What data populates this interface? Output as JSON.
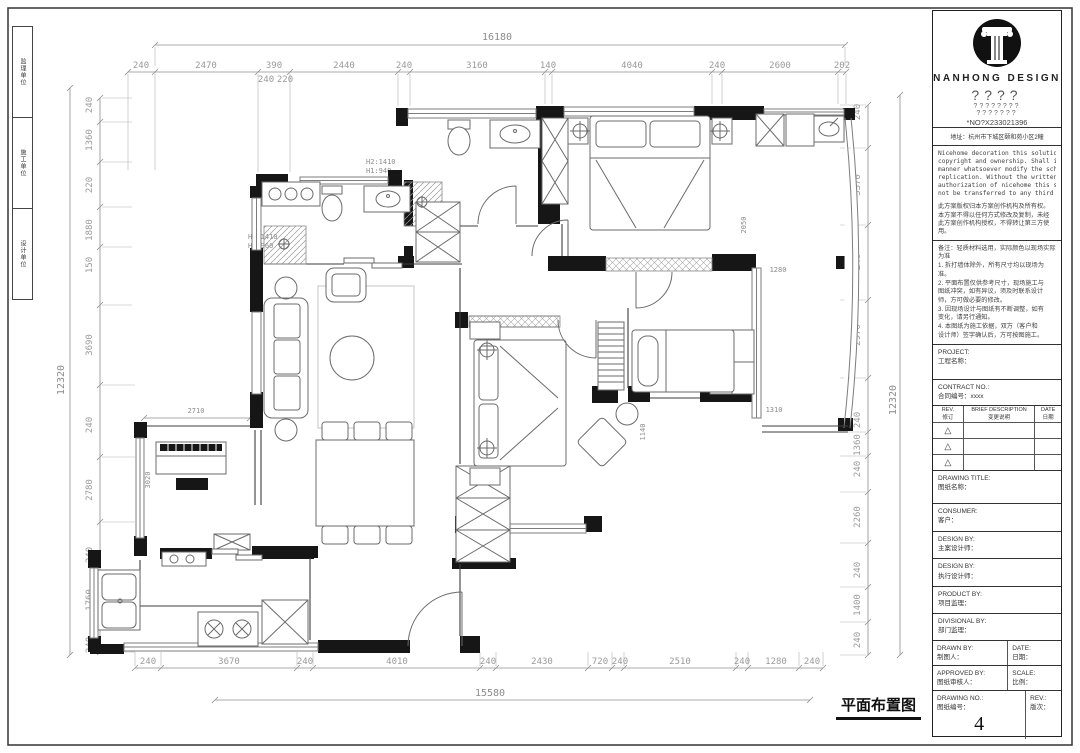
{
  "sheet": {
    "drawing_label": "平面布置图",
    "side_strip": [
      "监理单位",
      "施工单位",
      "设计单位"
    ]
  },
  "dimensions": {
    "top": {
      "total": "16180",
      "segments": [
        "240",
        "2470",
        "390",
        "2440",
        "240",
        "3160",
        "140",
        "4040",
        "240",
        "2600",
        "202"
      ],
      "sub": [
        "240",
        "220"
      ]
    },
    "bottom": {
      "total": "15580",
      "segments": [
        "240",
        "3670",
        "240",
        "4010",
        "240",
        "2430",
        "720",
        "240",
        "2510",
        "240",
        "1280",
        "240"
      ]
    },
    "left": {
      "total": "12320",
      "segments": [
        "240",
        "1360",
        "220",
        "1880",
        "150",
        "3690",
        "240",
        "2780",
        "240",
        "1760",
        "240"
      ]
    },
    "right": {
      "total": "12320",
      "segments": [
        "240",
        "3370",
        "240",
        "2970",
        "240",
        "1360",
        "240",
        "2260",
        "240",
        "1400",
        "240"
      ]
    },
    "interior": {
      "piano_width": "2710",
      "piano_depth": "3020",
      "master_window": "2050",
      "balcony_top": "1280",
      "balcony_bottom": "1310",
      "bedroom2_wall": "1140"
    }
  },
  "annotations": {
    "bath_top_h2": "H2:1410",
    "bath_top_h1": "H1:940",
    "bath_left_h2": "H2:1410",
    "bath_left_h1": "H1:960"
  },
  "title_block": {
    "company": "NANHONG  DESIGN",
    "tagline1": "????",
    "tagline2": "????????",
    "tagline3": "???????",
    "no_line": "*NO?X233021396",
    "address": "地址：杭州市下城区颐和苑小区2幢",
    "disclaimer_en": [
      "Nicehome decoration this solution has the",
      "copyright and ownership. Shall in no",
      "manner whatsoever modify the scheme and",
      "replication. Without the written",
      "authorization of nicehome this scheme may",
      "not be transferred to any third party."
    ],
    "disclaimer_cn": [
      "此方案版权归本方案创作机构及所有权。",
      "本方案不得以任何方式修改及复制，未经",
      "此方案创作机构授权，不得转让第三方使用。"
    ],
    "notes": [
      "备注：轻质材料选用，实际颜色以现场实际为准",
      "1. 拆打墙体除外，所有尺寸均以现场为准。",
      "2. 平面布置仅供参考尺寸，现场施工与",
      "图纸冲突，如有异议，须及时联系设计",
      "师，方可做必要的修改。",
      "3. 因现场设计与图纸有不断调整，如有",
      "变化，请另行通知。",
      "4. 本图纸为施工依据，双方（客户和",
      "设计师）签字确认后，方可按图施工。"
    ],
    "project_label": "PROJECT:",
    "project_cn": "工程名称：",
    "contract_label": "CONTRACT NO.:",
    "contract_cn": "合同编号：xxxx",
    "rev_header": {
      "rev": "REV.",
      "rev_cn": "修订",
      "desc": "BRIEF DESCRIPTION",
      "desc_cn": "变更说明",
      "date": "DATE",
      "date_cn": "日期"
    },
    "rev_triangle": "△",
    "drawing_title_label": "DRAWING TITLE:",
    "drawing_title_cn": "图纸名称：",
    "consumer_label": "CONSUMER:",
    "consumer_cn": "客户：",
    "design1_label": "DESIGN BY:",
    "design1_cn": "主案设计师：",
    "design2_label": "DESIGN BY:",
    "design2_cn": "执行设计师：",
    "product_label": "PRODUCT BY:",
    "product_cn": "项目监理：",
    "divisional_label": "DIVISIONAL BY:",
    "divisional_cn": "部门监理：",
    "drawn_label": "DRAWN BY:",
    "drawn_cn": "制图人：",
    "date_label": "DATE:",
    "date_cn": "日期：",
    "approved_label": "APPROVED BY:",
    "approved_cn": "图纸审核人：",
    "scale_label": "SCALE:",
    "scale_cn": "比例：",
    "drawing_no_label": "DRAWING NO.:",
    "drawing_no_cn": "图纸编号：",
    "drawing_no_value": "4",
    "rev_label": "REV.:",
    "rev_cn": "版次："
  }
}
